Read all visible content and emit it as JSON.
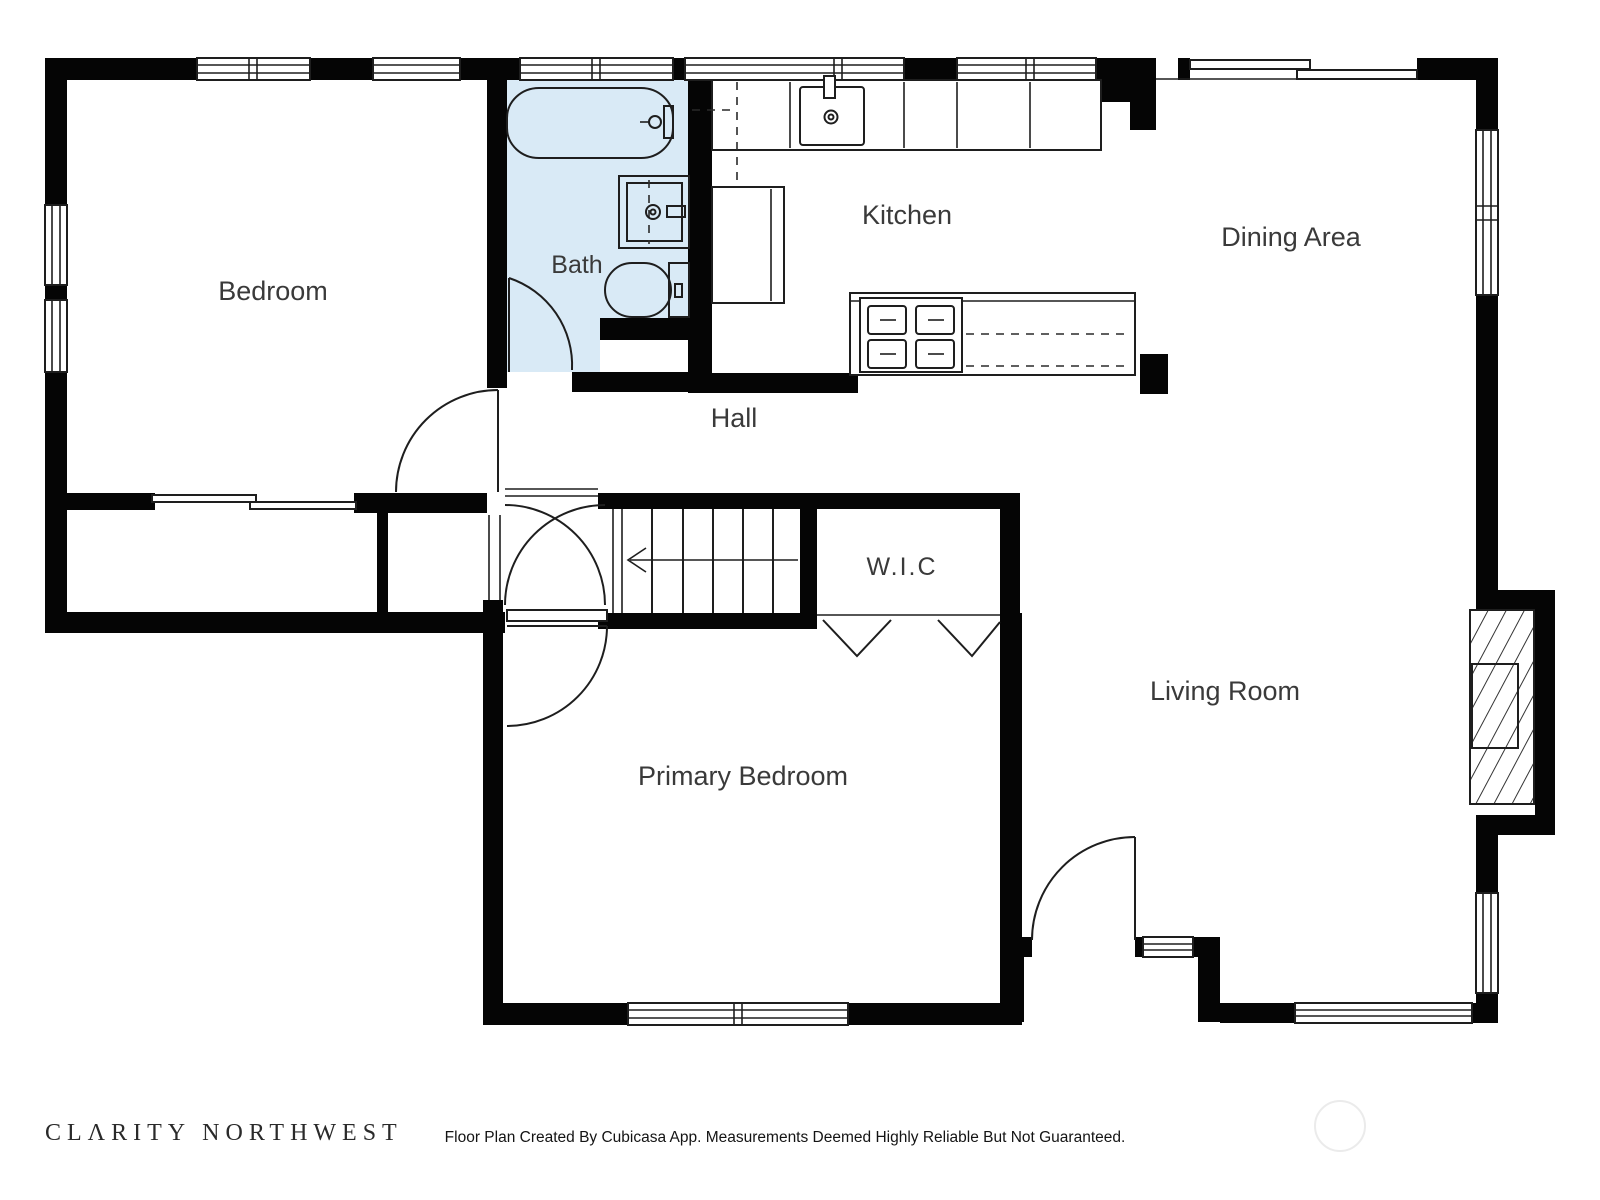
{
  "plan": {
    "rooms": [
      {
        "id": "bedroom",
        "label": "Bedroom"
      },
      {
        "id": "bath",
        "label": "Bath"
      },
      {
        "id": "kitchen",
        "label": "Kitchen"
      },
      {
        "id": "dining-area",
        "label": "Dining Area"
      },
      {
        "id": "hall",
        "label": "Hall"
      },
      {
        "id": "wic",
        "label": "W.I.C"
      },
      {
        "id": "primary-bedroom",
        "label": "Primary Bedroom"
      },
      {
        "id": "living-room",
        "label": "Living Room"
      }
    ],
    "stairs": {
      "direction_arrow": "left",
      "treads": 7
    },
    "fixtures": [
      "bathtub",
      "vanity-sink",
      "toilet",
      "kitchen-sink",
      "stove",
      "island-counter",
      "fireplace",
      "staircase",
      "closet-bifold-doors",
      "sliding-bypass-door",
      "patio-sliding-door"
    ],
    "colors": {
      "wall": "#050505",
      "bath_floor": "#d9eaf6",
      "line": "#1e1e1e",
      "label_text": "#3a3a3a",
      "watermark": "#ebebeb"
    }
  },
  "footer": {
    "brand": "CLΛRITY NORTHWEST",
    "disclaimer": "Floor Plan Created By Cubicasa App. Measurements Deemed Highly Reliable But Not Guaranteed."
  }
}
